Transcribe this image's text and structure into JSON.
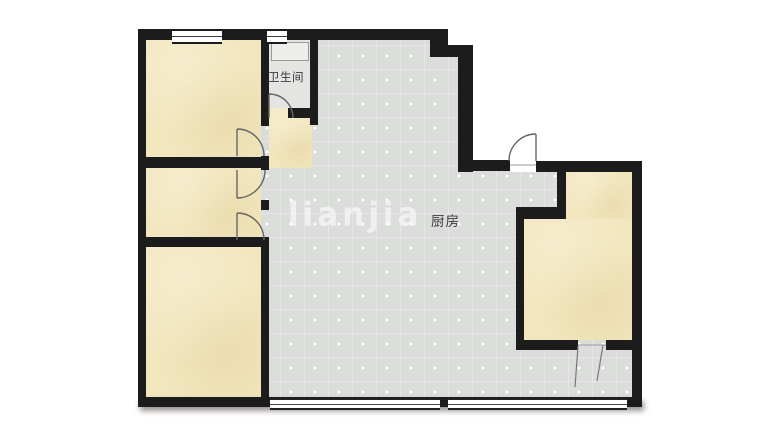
{
  "floorplan": {
    "labels": {
      "bathroom": "卫生间",
      "kitchen": "厨房"
    },
    "watermark": "LIANJIA",
    "rooms": {
      "bathroom": "卫生间",
      "kitchen": "厨房",
      "bedroom_top_left": "",
      "bedroom_middle_left": "",
      "bedroom_bottom_left": "",
      "bedroom_right": "",
      "balcony": ""
    },
    "colors": {
      "wall": "#1c1c1c",
      "bedroom_floor": "#f2e6bd",
      "tile_floor": "#dbdddb",
      "bathroom_floor": "#e4e4e2",
      "door_stroke": "#666666",
      "background": "#ffffff",
      "watermark_color": "rgba(255,255,255,0.55)"
    }
  }
}
